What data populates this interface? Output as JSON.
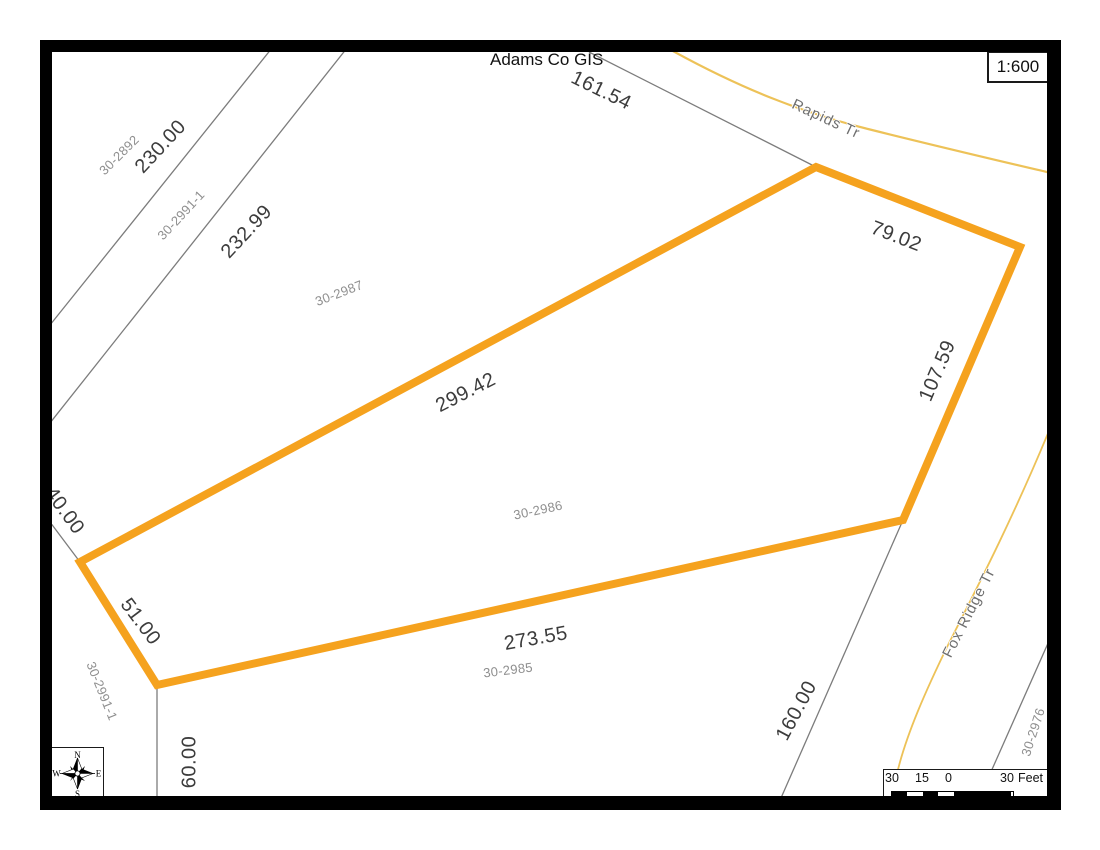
{
  "header": {
    "title": "Adams Co GIS",
    "scale_ratio": "1:600"
  },
  "dimensions": [
    {
      "text": "161.54"
    },
    {
      "text": "79.02"
    },
    {
      "text": "107.59"
    },
    {
      "text": "299.42"
    },
    {
      "text": "273.55"
    },
    {
      "text": "51.00"
    },
    {
      "text": "230.00"
    },
    {
      "text": "232.99"
    },
    {
      "text": "40.00"
    },
    {
      "text": "60.00"
    },
    {
      "text": "160.00"
    }
  ],
  "parcels": [
    {
      "id": "30-2892"
    },
    {
      "id": "30-2991-1"
    },
    {
      "id": "30-2987"
    },
    {
      "id": "30-2986"
    },
    {
      "id": "30-2985"
    },
    {
      "id": "30-2991-1"
    },
    {
      "id": "30-2976"
    }
  ],
  "roads": [
    {
      "name": "Rapids Tr"
    },
    {
      "name": "Fox Ridge Tr"
    }
  ],
  "compass": {
    "north": "N",
    "south": "S",
    "east": "E",
    "west": "W"
  },
  "scale_bar": {
    "labels": [
      "30",
      "15",
      "0",
      "30"
    ],
    "unit": "Feet"
  },
  "colors": {
    "parcel_highlight": "#F5A21E",
    "road": "#EDC258",
    "boundary": "#7c7c7c"
  }
}
